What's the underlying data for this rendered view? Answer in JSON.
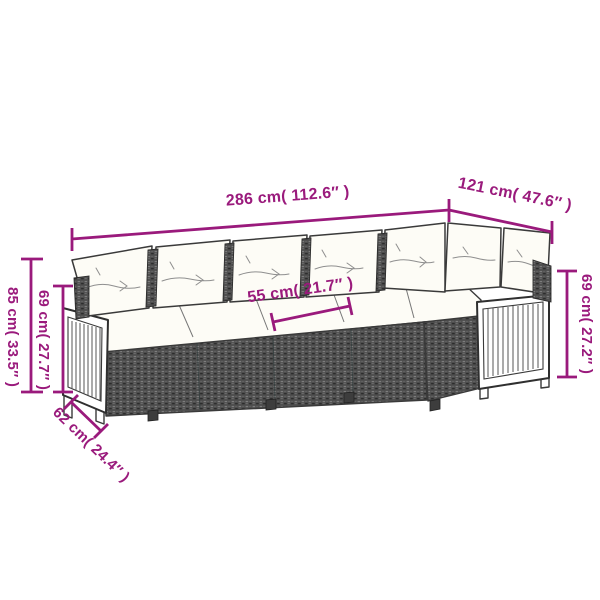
{
  "diagram": {
    "type": "product-dimension-diagram",
    "product": "L-shaped rattan garden sofa set with cushions",
    "colors": {
      "accent": "#9a1a7c",
      "outline": "#3a3a3a",
      "rattan": "#4d4d4d",
      "rattan_dot": "#7d7d7d",
      "cushion": "#fdfcf6",
      "wood": "#ffffff",
      "background": "#ffffff"
    },
    "labels": {
      "total_width": "286 cm( 112.6″ )",
      "side_depth": "121 cm( 47.6″ )",
      "total_height": "85 cm( 33.5″ )",
      "back_height_left": "69 cm( 27.7″ )",
      "seat_width": "55 cm( 21.7″ )",
      "seat_depth": "62 cm( 24.4″ )",
      "side_height_right": "69 cm( 27.2″ )"
    }
  }
}
